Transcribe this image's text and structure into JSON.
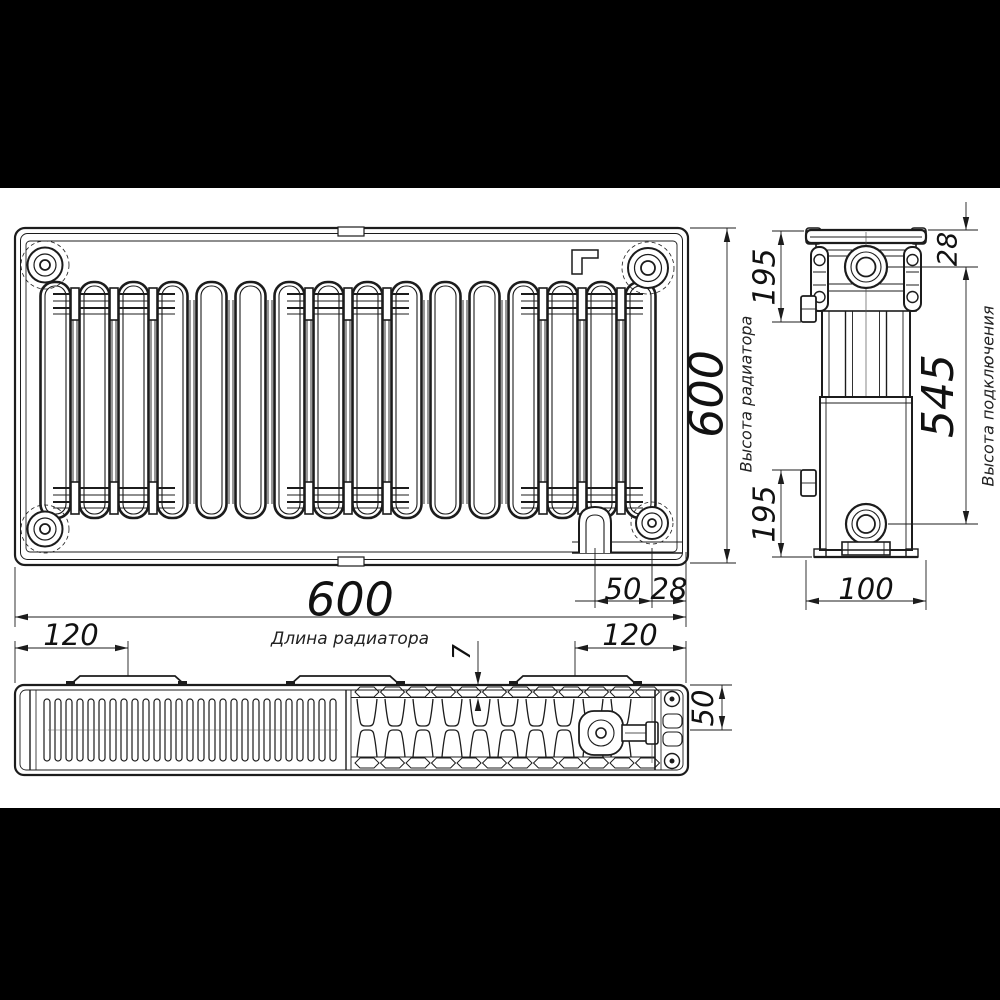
{
  "colors": {
    "background": "#ffffff",
    "line": "#1c1c1c",
    "letterbox": "#000000"
  },
  "front_view": {
    "length": "600",
    "length_label": "Длина радиатора",
    "height": "600",
    "height_label": "Высота радиатора",
    "drain_offset": "50",
    "edge_offset": "28"
  },
  "side_view": {
    "top_port_offset": "28",
    "connection_height": "545",
    "connection_label": "Высота подключения",
    "bracket_top_offset": "195",
    "bracket_bottom_offset": "195",
    "depth": "100"
  },
  "top_view": {
    "pad_left_offset": "120",
    "pad_right_offset": "120",
    "panel_thickness": "7",
    "half_depth": "50"
  }
}
